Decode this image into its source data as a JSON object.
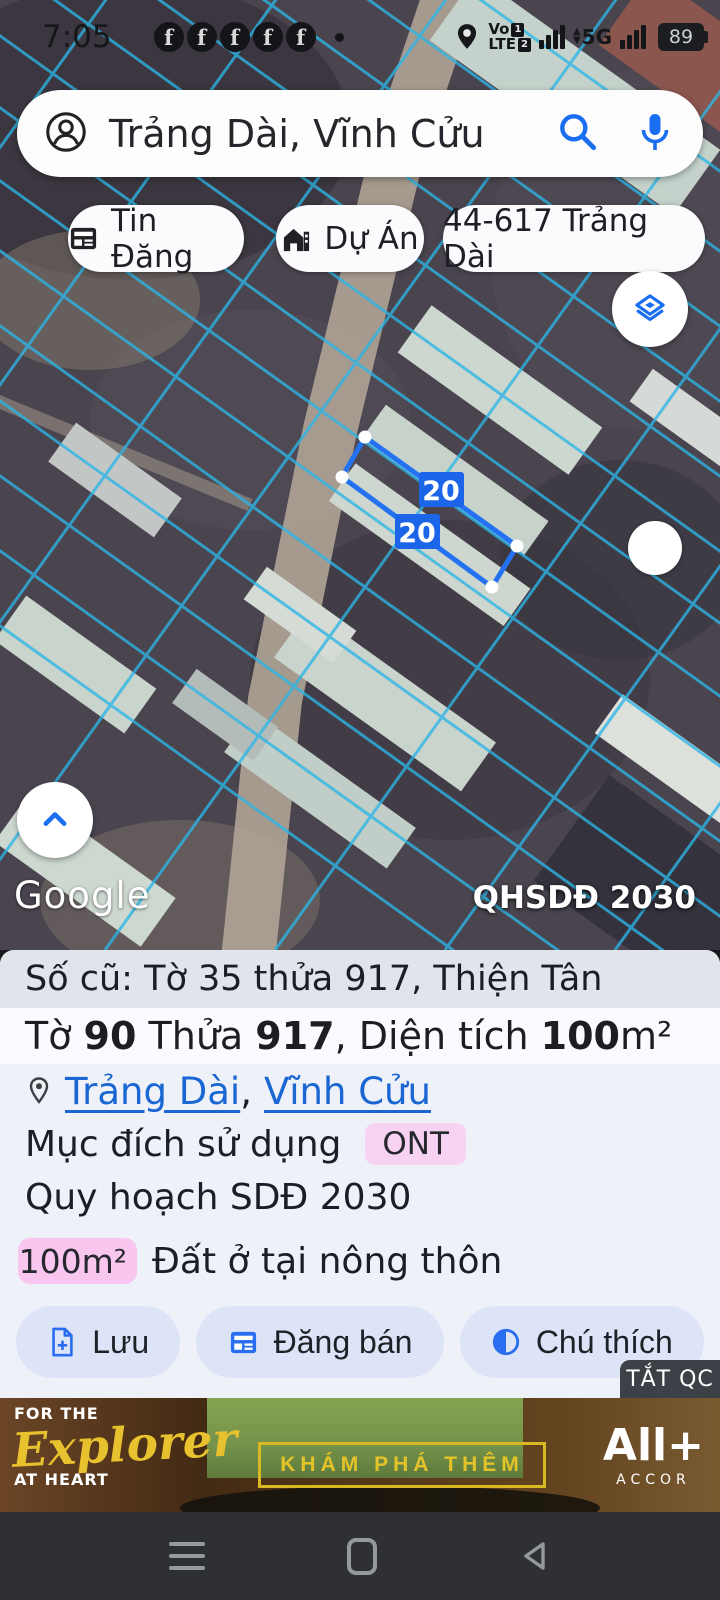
{
  "status_bar": {
    "time": "7:05",
    "volte_top": "Vo",
    "volte_bottom": "LTE",
    "sim1": "1",
    "sim2": "2",
    "network": "5G",
    "battery_percent": "89"
  },
  "search": {
    "query": "Trảng Dài, Vĩnh Cửu"
  },
  "chips": [
    {
      "label": "Tin Đăng"
    },
    {
      "label": "Dự Án"
    },
    {
      "label": "44-617 Trảng Dài"
    }
  ],
  "map": {
    "dim_labels": [
      "20",
      "20"
    ],
    "watermark": "Google",
    "overlay_label": "QHSDĐ 2030",
    "colors": {
      "cadastral_line": "#2db5e6",
      "parcel_highlight": "#2472f2",
      "accent_blue": "#1a6ef0"
    }
  },
  "info_panel": {
    "old_ref": "Số cũ: Tờ 35 thửa 917, Thiện Tân",
    "title": {
      "t1": "Tờ ",
      "b1": "90",
      "t2": " Thửa ",
      "b2": "917",
      "t3": ", Diện tích ",
      "b3": "100",
      "t4": "m²"
    },
    "links": [
      {
        "label": "Trảng Dài"
      },
      {
        "label": "Vĩnh Cửu"
      }
    ],
    "link_separator": ",",
    "purpose_label": "Mục đích sử dụng",
    "purpose_code": "ONT",
    "planning": "Quy hoạch SDĐ 2030",
    "area_badge": "100m²",
    "land_type": "Đất ở tại nông thôn",
    "buttons": [
      {
        "label": "Lưu"
      },
      {
        "label": "Đăng bán"
      },
      {
        "label": "Chú thích"
      }
    ],
    "colors": {
      "ont_badge_bg": "#f8d2f3",
      "area_badge_bg": "#f9c6ef"
    }
  },
  "ad": {
    "close_label": "TẮT QC",
    "tagline_top": "FOR THE",
    "tagline_script": "Explorer",
    "tagline_bottom": "AT HEART",
    "cta": "KHÁM PHÁ THÊM",
    "brand": "All+",
    "brand_sub": "ACCOR"
  },
  "icons": [
    "facebook-icon",
    "location-pin-icon",
    "signal-bars-icon",
    "battery-icon",
    "person-circle-icon",
    "search-icon",
    "mic-icon",
    "newspaper-icon",
    "house-icon",
    "layers-icon",
    "chevron-up-icon",
    "map-pin-outline-icon",
    "file-plus-icon",
    "calendar-list-icon",
    "contrast-icon",
    "menu-icon",
    "home-icon",
    "back-icon"
  ]
}
